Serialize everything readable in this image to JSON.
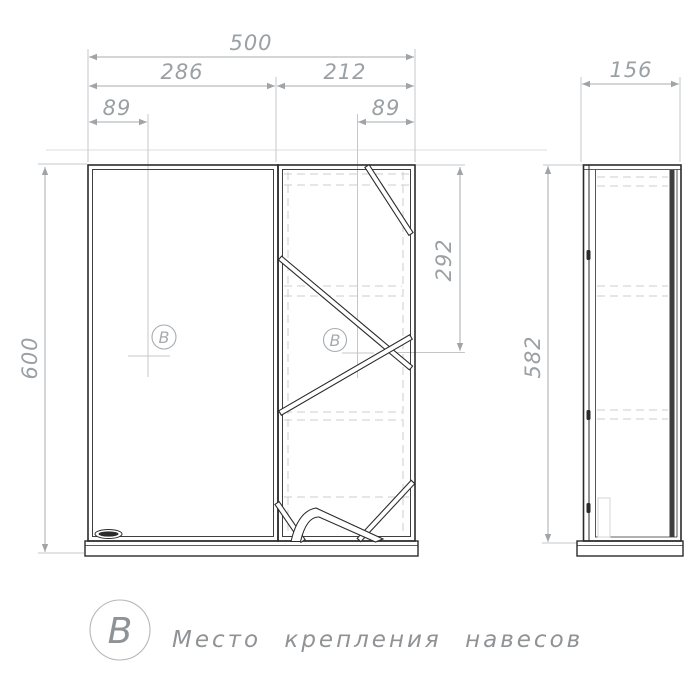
{
  "front_view": {
    "dim_width_total": "500",
    "dim_width_left": "286",
    "dim_width_right": "212",
    "dim_offset_left": "89",
    "dim_offset_right": "89",
    "dim_height_total": "600",
    "dim_mount_height": "292",
    "marker_left": "B",
    "marker_right": "B"
  },
  "side_view": {
    "dim_depth": "156",
    "dim_height": "582"
  },
  "legend": {
    "symbol": "B",
    "label": "Место крепления навесов"
  },
  "colors": {
    "line": "#2b2b2b",
    "dimension": "#9aa0a3",
    "hidden_line": "#cccccc",
    "background": "#ffffff"
  }
}
